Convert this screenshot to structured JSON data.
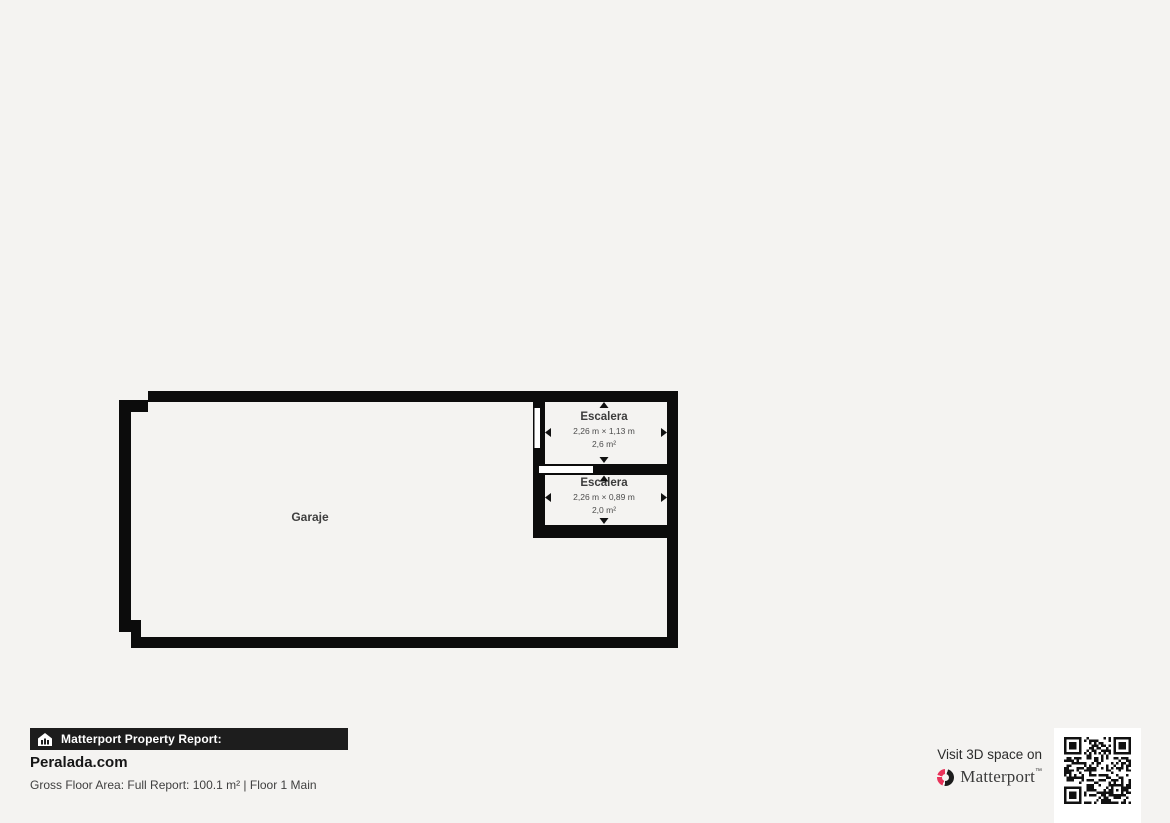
{
  "floor_plan": {
    "garage": {
      "label": "Garaje"
    },
    "stair_upper": {
      "label": "Escalera",
      "dimensions": "2,26 m × 1,13 m",
      "area": "2,6 m²"
    },
    "stair_lower": {
      "label": "Escalera",
      "dimensions": "2,26 m × 0,89 m",
      "area": "2,0 m²"
    }
  },
  "footer": {
    "report_label": "Matterport Property Report:",
    "site_name": "Peralada.com",
    "summary_line": "Gross Floor Area: Full Report: 100.1 m² | Floor 1 Main",
    "visit_text": "Visit 3D space on",
    "brand_name": "Matterport",
    "trademark": "™"
  },
  "colors": {
    "background": "#f4f3f1",
    "wall": "#0c0c0c",
    "plan_interior": "#ffffff",
    "bar_background": "#1d1d1d",
    "accent_pink": "#e8335a"
  }
}
